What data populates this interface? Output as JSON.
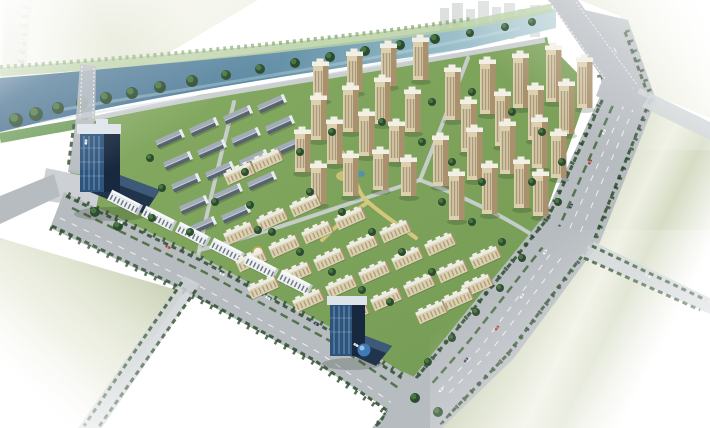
{
  "palette": {
    "bg": "#ffffff",
    "wash_sage": "#e4e8d5",
    "sage_field": "#d7dcc4",
    "river_deep": "#47708f",
    "river_light": "#bdd6da",
    "bank_grass": "#6f9c5a",
    "bank_light": "#b9d0a4",
    "tree_dark": "#2c4c30",
    "tree_light": "#4e7c42",
    "hedge": "#3c5a3a",
    "site_green": "#7ca35d",
    "road": "#b7bcc1",
    "road_light": "#cdd1d5",
    "lane": "#eff1f2",
    "beige_face": "#ddd0ae",
    "beige_side": "#a9916d",
    "beige_win": "#7c6c51",
    "beige_crown": "#f2efe5",
    "slab_roof": "#ecebe3",
    "row_light": "#a3adb8",
    "row_dark": "#57636e",
    "row_gable": "#eaedf0",
    "white_face": "#eff1f3",
    "white_band": "#4e5d6c",
    "white_roof": "#f6f8f9",
    "white_side": "#c3c9cf",
    "glass_face": "#2f547c",
    "glass_side": "#18293f",
    "glass_mull": "#7fa6c6",
    "glass_crown": "#dde4ea",
    "podium": "#20344c",
    "dome": "#3e7ab8",
    "path_yellow": "#d9c87c",
    "plaza_gold": "#c9a94e"
  },
  "scene": {
    "apartment_towers": [
      [
        320,
        100,
        34
      ],
      [
        354,
        92,
        36
      ],
      [
        388,
        86,
        38
      ],
      [
        420,
        80,
        38
      ],
      [
        452,
        120,
        48
      ],
      [
        487,
        114,
        50
      ],
      [
        520,
        108,
        50
      ],
      [
        553,
        102,
        52
      ],
      [
        584,
        108,
        46
      ],
      [
        468,
        152,
        48
      ],
      [
        502,
        146,
        50
      ],
      [
        535,
        140,
        50
      ],
      [
        566,
        134,
        48
      ],
      [
        318,
        140,
        40
      ],
      [
        350,
        132,
        42
      ],
      [
        382,
        124,
        42
      ],
      [
        412,
        132,
        38
      ],
      [
        440,
        186,
        46
      ],
      [
        474,
        180,
        48
      ],
      [
        507,
        174,
        48
      ],
      [
        539,
        168,
        46
      ],
      [
        558,
        178,
        42
      ],
      [
        302,
        172,
        38
      ],
      [
        334,
        164,
        40
      ],
      [
        366,
        156,
        40
      ],
      [
        396,
        162,
        36
      ],
      [
        456,
        220,
        44
      ],
      [
        489,
        214,
        46
      ],
      [
        521,
        208,
        44
      ],
      [
        540,
        216,
        40
      ],
      [
        318,
        204,
        36
      ],
      [
        350,
        196,
        38
      ],
      [
        380,
        190,
        36
      ],
      [
        408,
        196,
        34
      ]
    ],
    "midrise_slabs": [
      [
        240,
        235
      ],
      [
        273,
        221
      ],
      [
        306,
        207
      ],
      [
        252,
        262
      ],
      [
        285,
        248
      ],
      [
        318,
        234
      ],
      [
        351,
        220
      ],
      [
        264,
        289
      ],
      [
        297,
        275
      ],
      [
        330,
        261
      ],
      [
        363,
        247
      ],
      [
        396,
        233
      ],
      [
        309,
        302
      ],
      [
        342,
        288
      ],
      [
        375,
        274
      ],
      [
        408,
        260
      ],
      [
        441,
        246
      ],
      [
        354,
        315
      ],
      [
        387,
        301
      ],
      [
        420,
        287
      ],
      [
        453,
        273
      ],
      [
        486,
        259
      ],
      [
        432,
        314
      ],
      [
        458,
        301
      ],
      [
        478,
        287
      ],
      [
        240,
        175
      ],
      [
        268,
        162
      ]
    ],
    "rowhouses": [
      [
        170,
        140
      ],
      [
        204,
        128
      ],
      [
        238,
        116
      ],
      [
        272,
        105
      ],
      [
        178,
        162
      ],
      [
        212,
        150
      ],
      [
        246,
        138
      ],
      [
        280,
        126
      ],
      [
        186,
        184
      ],
      [
        220,
        172
      ],
      [
        254,
        160
      ],
      [
        288,
        148
      ],
      [
        194,
        206
      ],
      [
        228,
        194
      ],
      [
        262,
        182
      ],
      [
        202,
        227
      ],
      [
        236,
        215
      ]
    ],
    "white_slabs": [
      [
        124,
        204
      ],
      [
        158,
        220
      ],
      [
        192,
        236
      ],
      [
        226,
        252
      ],
      [
        260,
        268
      ],
      [
        294,
        284
      ]
    ],
    "bank_trees": [
      [
        16,
        120,
        7
      ],
      [
        36,
        114,
        7
      ],
      [
        58,
        108,
        6
      ],
      [
        82,
        103,
        6
      ],
      [
        106,
        98,
        6
      ],
      [
        132,
        93,
        6
      ],
      [
        160,
        87,
        6
      ],
      [
        192,
        81,
        6
      ],
      [
        226,
        75,
        5
      ],
      [
        260,
        69,
        5
      ],
      [
        295,
        63,
        5
      ],
      [
        330,
        57,
        5
      ],
      [
        365,
        51,
        5
      ],
      [
        400,
        45,
        5
      ],
      [
        435,
        39,
        5
      ],
      [
        470,
        33,
        4
      ],
      [
        505,
        27,
        4
      ],
      [
        532,
        22,
        4
      ]
    ],
    "trees": [
      [
        150,
        158,
        4
      ],
      [
        162,
        188,
        4
      ],
      [
        152,
        218,
        4
      ],
      [
        250,
        205,
        4
      ],
      [
        272,
        232,
        4
      ],
      [
        300,
        252,
        4
      ],
      [
        332,
        272,
        4
      ],
      [
        362,
        290,
        4
      ],
      [
        390,
        302,
        4
      ],
      [
        310,
        192,
        4
      ],
      [
        342,
        212,
        4
      ],
      [
        372,
        232,
        4
      ],
      [
        402,
        252,
        4
      ],
      [
        432,
        272,
        4
      ],
      [
        300,
        152,
        4
      ],
      [
        332,
        132,
        4
      ],
      [
        382,
        122,
        4
      ],
      [
        422,
        142,
        4
      ],
      [
        452,
        162,
        4
      ],
      [
        482,
        182,
        4
      ],
      [
        442,
        202,
        4
      ],
      [
        472,
        222,
        4
      ],
      [
        502,
        242,
        4
      ],
      [
        432,
        102,
        4
      ],
      [
        472,
        92,
        4
      ],
      [
        512,
        112,
        4
      ],
      [
        542,
        132,
        4
      ],
      [
        562,
        162,
        4
      ],
      [
        532,
        182,
        4
      ],
      [
        558,
        202,
        4
      ],
      [
        245,
        172,
        4
      ],
      [
        215,
        202,
        4
      ],
      [
        190,
        232,
        4
      ],
      [
        522,
        258,
        4
      ],
      [
        500,
        288,
        4
      ],
      [
        476,
        312,
        4
      ],
      [
        452,
        338,
        4
      ],
      [
        428,
        362,
        4
      ],
      [
        95,
        212,
        5
      ],
      [
        118,
        226,
        5
      ],
      [
        415,
        398,
        5
      ],
      [
        438,
        412,
        5
      ],
      [
        258,
        230,
        4
      ]
    ],
    "cars": [
      {
        "x": 604,
        "y": 132,
        "a": 118,
        "c": "#f2f5f7"
      },
      {
        "x": 590,
        "y": 162,
        "a": 118,
        "c": "#b5382b"
      },
      {
        "x": 571,
        "y": 206,
        "a": 118,
        "c": "#31405a"
      },
      {
        "x": 545,
        "y": 252,
        "a": 122,
        "c": "#f2f5f7"
      },
      {
        "x": 522,
        "y": 296,
        "a": 126,
        "c": "#f2f5f7"
      },
      {
        "x": 497,
        "y": 328,
        "a": 128,
        "c": "#b5382b"
      },
      {
        "x": 466,
        "y": 360,
        "a": 132,
        "c": "#31405a"
      },
      {
        "x": 441,
        "y": 390,
        "a": 135,
        "c": "#f2f5f7"
      },
      {
        "x": 120,
        "y": 222,
        "a": 26,
        "c": "#f2f5f7"
      },
      {
        "x": 168,
        "y": 247,
        "a": 26,
        "c": "#b5382b"
      },
      {
        "x": 222,
        "y": 274,
        "a": 27,
        "c": "#f2f5f7"
      },
      {
        "x": 268,
        "y": 298,
        "a": 28,
        "c": "#f2f5f7"
      },
      {
        "x": 316,
        "y": 324,
        "a": 29,
        "c": "#31405a"
      },
      {
        "x": 356,
        "y": 345,
        "a": 30,
        "c": "#f2f5f7"
      },
      {
        "x": 86,
        "y": 142,
        "a": 94,
        "c": "#f2f5f7"
      },
      {
        "x": 648,
        "y": 276,
        "a": 27,
        "c": "#f2f5f7"
      }
    ]
  }
}
